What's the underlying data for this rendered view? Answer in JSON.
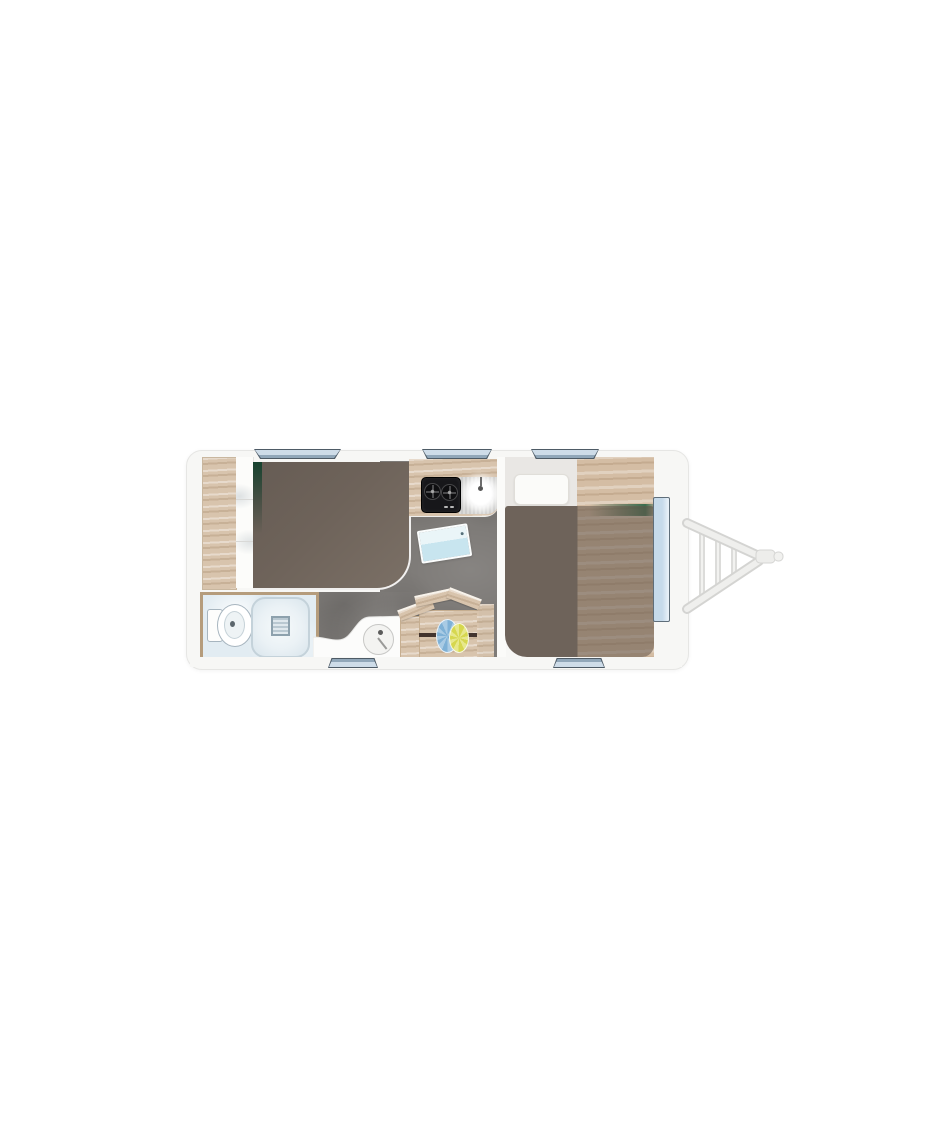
{
  "scene": {
    "title": "caravan-floorplan",
    "description": "Top-down floor plan of a single-axle travel caravan with front A-frame hitch, shown on a plain white background. No visible text labels.",
    "orientation": "hitch-right"
  },
  "palette": {
    "bg": "#ffffff",
    "body_fill": "#f7f7f5",
    "body_border": "#e6e6e4",
    "wood": "#d8c4ad",
    "wood_dark": "#c3aa8c",
    "wood_light": "#e9dbc9",
    "wood_warm": "#d4bda4",
    "bed_dark": "#6e635a",
    "bed_dark2": "#7b7066",
    "accent_green": "#17432f",
    "floor": "#7e7b78",
    "bath_floor": "#e2ecf2",
    "fixture_outline": "#a7b5bf",
    "window_fill": "#cedce8",
    "window_sill2": "#91a7b9",
    "window_border": "#4e5b66",
    "door_fill": "#c6daea",
    "door_border": "#5f6e7a",
    "hob": "#17171a",
    "steel": "#d6d6d4",
    "hitch": "#ececea",
    "hitch_border": "#d2d2d0",
    "table_line": "#43342e",
    "rosette_blue": "#7fb1d6",
    "rosette_yellow": "#d6d74f",
    "vanity": "#fcfcfb"
  },
  "zones": {
    "rear_left": {
      "name": "lounge-bed-area",
      "features": [
        "wardrobe",
        "open-shelves",
        "french-bed-dark-upholstery",
        "green-accent-strip"
      ]
    },
    "washroom": {
      "name": "washroom",
      "features": [
        "toilet",
        "shower-tray-with-drain"
      ]
    },
    "kitchen": {
      "name": "kitchen",
      "features": [
        "worktop",
        "two-burner-hob",
        "round-sink-with-drainer",
        "folding-shelf-blue"
      ]
    },
    "dinette": {
      "name": "dinette",
      "features": [
        "wood-table",
        "bench-left",
        "bench-right",
        "angled-backrests",
        "blue-rosette-decor",
        "yellow-rosette-decor",
        "washbasin-counter"
      ]
    },
    "front_bed": {
      "name": "front-bedroom",
      "features": [
        "single-bed-dark-blanket",
        "white-pillow",
        "wood-bed-platform",
        "green-accent-strip"
      ]
    }
  },
  "openings": {
    "windows_top_count": 3,
    "windows_bottom_count": 2,
    "entry_door_count": 1
  },
  "chassis": {
    "hitch": "a-frame-drawbar-with-coupling-head",
    "hitch_rungs": 3
  }
}
